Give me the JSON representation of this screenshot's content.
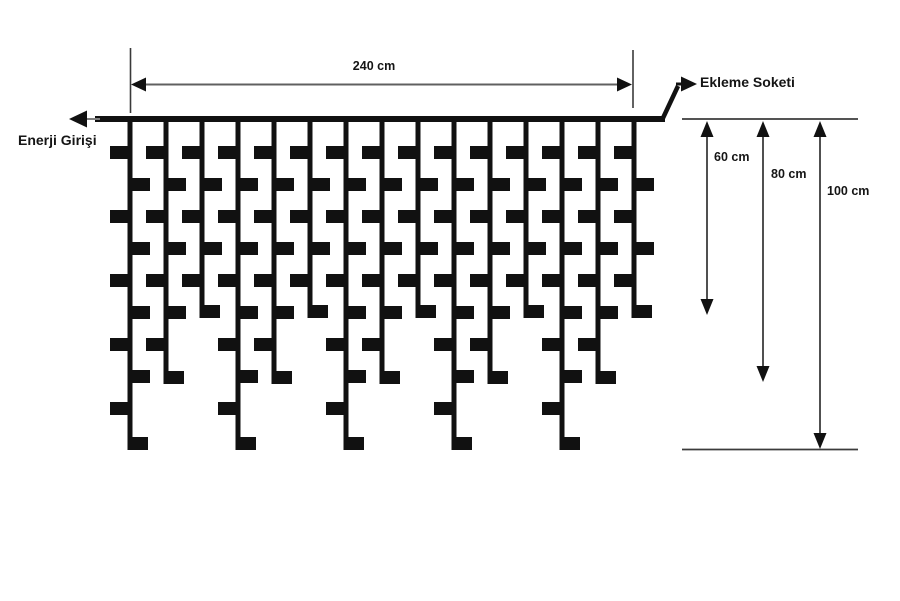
{
  "page": {
    "width_px": 900,
    "height_px": 601
  },
  "colors": {
    "ink": "#111111",
    "dimension_line": "#606060",
    "measure_line": "#3c3c3c",
    "tail_gray": "#808080",
    "background": "#ffffff"
  },
  "curtain": {
    "wire": {
      "x_start": 95,
      "x_end": 665,
      "y": 116,
      "thickness": 6
    },
    "drop_count": 15,
    "first_drop_x": 130,
    "drop_spacing_px": 36,
    "drop_line_width": 5,
    "led_tab": {
      "width": 22,
      "height": 13,
      "first_top_y": 146,
      "pitch_px": 32
    },
    "length_pattern_cm": [
      100,
      80,
      60
    ],
    "drop_bottom_y_by_cm": {
      "100": 450,
      "80": 384,
      "60": 318
    }
  },
  "width_dimension": {
    "label": "240 cm",
    "line_y": 84.5,
    "x_start": 131,
    "x_end": 632,
    "left_tick": {
      "x": 130.5,
      "y1": 48,
      "y2": 113
    },
    "right_tick": {
      "x": 633,
      "y1": 50,
      "y2": 108
    },
    "label_pos": {
      "x": 374,
      "y": 60
    }
  },
  "power_input": {
    "label": "Enerji Girişi",
    "arrow_tip": {
      "x": 69,
      "y": 119
    },
    "tail": {
      "x1": 84,
      "x2": 100
    },
    "label_pos": {
      "x": 18,
      "y": 133
    }
  },
  "extension_socket": {
    "label": "Ekleme Soketi",
    "diag_from": {
      "x": 663,
      "y": 118
    },
    "diag_to": {
      "x": 678,
      "y": 86
    },
    "connector": {
      "x1": 676,
      "x2": 684,
      "y": 84
    },
    "arrow_tip": {
      "x": 697,
      "y": 84
    },
    "label_pos": {
      "x": 700,
      "y": 75
    }
  },
  "depth_measurements": {
    "top_line": {
      "y": 119,
      "x_start": 682,
      "x_end": 858
    },
    "bottom_line": {
      "y": 449.5,
      "x_start": 682,
      "x_end": 858
    },
    "arrows": [
      {
        "label": "60 cm",
        "x": 707,
        "y_end": 315,
        "label_pos": {
          "x": 714,
          "y": 151
        }
      },
      {
        "label": "80 cm",
        "x": 763,
        "y_end": 382,
        "label_pos": {
          "x": 771,
          "y": 168
        }
      },
      {
        "label": "100 cm",
        "x": 820,
        "y_end": 449,
        "label_pos": {
          "x": 827,
          "y": 185
        }
      }
    ]
  }
}
